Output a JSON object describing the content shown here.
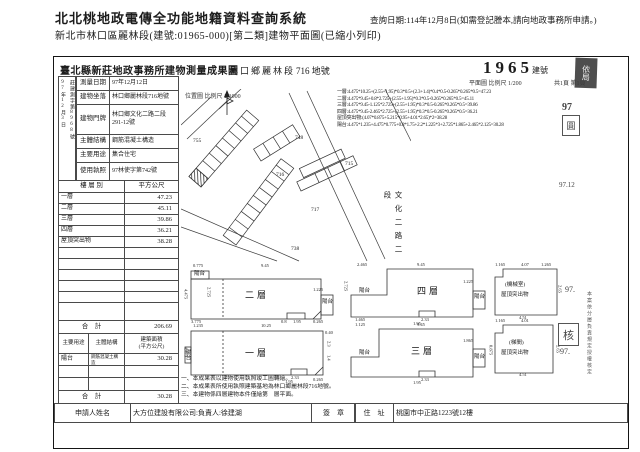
{
  "header": {
    "system_title": "北北桃地政電傳全功能地籍資料查詢系統",
    "query_date": "查詢日期:114年12月8日(如需登記謄本,請向地政事務所申請。)",
    "doc_line": "新北市林口區麗林段(建號:01965-000)[第二類]建物平面圖(已縮小列印)"
  },
  "form": {
    "title": "臺北縣新莊地政事務所建物測量成果圖",
    "section_name": "林口鄉麗林段",
    "parcel_no": "716 地號",
    "building_no": "1965",
    "building_no_label": "建號",
    "scale_site": "位置圖 比例尺 1/1000",
    "scale_plan": "平面圖 比例尺 1/200",
    "page_no": "共1頁 第1頁",
    "receipt": {
      "date": "97年12月3日",
      "no": "莊建測字第8968號"
    },
    "info_rows": [
      {
        "label": "測量日期",
        "value": "97年12月12日"
      },
      {
        "label": "建物坐落",
        "value": "林口鄉麗林段716地號"
      },
      {
        "label": "建物門牌",
        "value": "林口鄉文化二路二段291-12號"
      },
      {
        "label": "主體結構",
        "value": "鋼筋混凝土構造"
      },
      {
        "label": "主要用途",
        "value": "集合住宅"
      },
      {
        "label": "使用執照",
        "value": "97林使字第742號"
      }
    ],
    "floor_table": {
      "col_floor": "樓 層 別",
      "col_area": "平方公尺",
      "rows": [
        {
          "label": "一層",
          "value": "47.23"
        },
        {
          "label": "二層",
          "value": "45.11"
        },
        {
          "label": "三層",
          "value": "39.86"
        },
        {
          "label": "四層",
          "value": "36.21"
        },
        {
          "label": "屋頂突出物",
          "value": "38.28"
        }
      ],
      "total_label": "合　計",
      "total": "206.69"
    },
    "annex_table": {
      "col_use": "主要用途",
      "col_structure": "主體結構",
      "col_area": "建築面積",
      "col_area2": "(平方公尺)",
      "row": {
        "use": "陽台",
        "structure": "鋼筋混凝土構造",
        "area": "30.28"
      },
      "total_label": "合　計",
      "total": "30.28"
    },
    "applicant": {
      "label": "申請人姓名",
      "name": "大方位建設有限公司:負責人:徐建湖",
      "seal": "簽　章",
      "addr_label": "住　址",
      "address": "桃園市中正路1223號12樓"
    },
    "notes": [
      "一、本成果表以建物使用執照竣工圖轉繪。",
      "二、本成果表所使用執照建築基地為林口鄉麗林段716地號。",
      "三、本建物係四層建物本件僅繪第　層平面。"
    ],
    "calculations": [
      "一層:4.475*10.25+(2.55+1.95)*0.3*0.5+(2.3+1.4)*0.4*0.5-0.265*0.265*0.5=47.23",
      "二層:4.475*9.45+0.8*2.725+(2.55+1.95)*0.3*0.5-0.265*0.265*0.5=45.11",
      "三層:4.475*9.45-1.125*2.725+(2.55+1.95)*0.3*0.5-0.265*0.265*0.5=39.86",
      "四層:4.475*9.45-2.465*2.725+(2.55+1.95)*0.3*0.5-0.265*0.265*0.5=36.21",
      "屋頂突出物:(4.07*0.875+5.215*0.95+4.01*2.65)*2=38.28",
      "陽台:4.475*1.235+4.475*0.775+0.8*1.75+2.2*1.225*3+2.725*1.865+2.465*2.125=30.28"
    ],
    "site_plan": {
      "road_label": "文化二路二段",
      "labels": [
        {
          "t": "755",
          "x": 12,
          "y": 50,
          "b": 1
        },
        {
          "t": "748",
          "x": 114,
          "y": 47,
          "b": 1
        },
        {
          "t": "715",
          "x": 164,
          "y": 73,
          "b": 1
        },
        {
          "t": "716",
          "x": 95,
          "y": 84,
          "b": 1
        },
        {
          "t": "717",
          "x": 130,
          "y": 119,
          "b": 1
        },
        {
          "t": "738",
          "x": 110,
          "y": 158,
          "b": 1
        }
      ]
    },
    "floor_plans": {
      "labels": [
        {
          "t": "0.775",
          "x": 10,
          "y": 1
        },
        {
          "t": "9.45",
          "x": 78,
          "y": 1
        },
        {
          "t": "4.475",
          "x": 0,
          "y": 26,
          "v": 1
        },
        {
          "t": "陽台",
          "x": 11,
          "y": 9,
          "b": 1
        },
        {
          "t": "2.725",
          "x": 23,
          "y": 24,
          "v": 1
        },
        {
          "t": "二層",
          "x": 62,
          "y": 28,
          "n": 1
        },
        {
          "t": "1.225",
          "x": 130,
          "y": 25
        },
        {
          "t": "陽台",
          "x": 139,
          "y": 37,
          "b": 1
        },
        {
          "t": "3.775",
          "x": 8,
          "y": 57
        },
        {
          "t": "0.8",
          "x": 98,
          "y": 57
        },
        {
          "t": "1.95",
          "x": 110,
          "y": 57
        },
        {
          "t": "0.265",
          "x": 130,
          "y": 57
        },
        {
          "t": "1.235",
          "x": 10,
          "y": 61
        },
        {
          "t": "10.25",
          "x": 78,
          "y": 61
        },
        {
          "t": "4.475",
          "x": 0,
          "y": 84,
          "v": 1
        },
        {
          "t": "陽台",
          "x": 1,
          "y": 86,
          "v": 1,
          "b": 1
        },
        {
          "t": "一層",
          "x": 62,
          "y": 86,
          "n": 1
        },
        {
          "t": "0.40",
          "x": 142,
          "y": 68
        },
        {
          "t": "2.3",
          "x": 143,
          "y": 78,
          "v": 1
        },
        {
          "t": "1.4",
          "x": 143,
          "y": 92,
          "v": 1
        },
        {
          "t": "2.33",
          "x": 108,
          "y": 113
        },
        {
          "t": "1.95",
          "x": 102,
          "y": 117
        },
        {
          "t": "0.265",
          "x": 130,
          "y": 115
        },
        {
          "t": "2.465",
          "x": 174,
          "y": 0
        },
        {
          "t": "9.45",
          "x": 234,
          "y": 0
        },
        {
          "t": "2.725",
          "x": 160,
          "y": 18,
          "v": 1
        },
        {
          "t": "陽台",
          "x": 176,
          "y": 26,
          "b": 1
        },
        {
          "t": "1.465",
          "x": 172,
          "y": 55
        },
        {
          "t": "四層",
          "x": 234,
          "y": 24,
          "n": 1
        },
        {
          "t": "1.225",
          "x": 280,
          "y": 17
        },
        {
          "t": "陽台",
          "x": 291,
          "y": 32,
          "b": 1
        },
        {
          "t": "2.33",
          "x": 238,
          "y": 55
        },
        {
          "t": "1.95",
          "x": 230,
          "y": 59
        },
        {
          "t": "1.125",
          "x": 172,
          "y": 60
        },
        {
          "t": "9.45",
          "x": 234,
          "y": 60
        },
        {
          "t": "陽台",
          "x": 176,
          "y": 88,
          "b": 1
        },
        {
          "t": "三層",
          "x": 228,
          "y": 84,
          "n": 1
        },
        {
          "t": "1.865",
          "x": 280,
          "y": 76
        },
        {
          "t": "陽台",
          "x": 291,
          "y": 92,
          "b": 1
        },
        {
          "t": "2.33",
          "x": 238,
          "y": 115
        },
        {
          "t": "1.95",
          "x": 230,
          "y": 118
        },
        {
          "t": "1.165",
          "x": 312,
          "y": 0
        },
        {
          "t": "4.07",
          "x": 338,
          "y": 0
        },
        {
          "t": "1.265",
          "x": 358,
          "y": 0
        },
        {
          "t": "2.65",
          "x": 374,
          "y": 22,
          "v": 1
        },
        {
          "t": "(機械室)",
          "x": 322,
          "y": 20,
          "b": 1
        },
        {
          "t": "屋頂突出物",
          "x": 318,
          "y": 30,
          "b": 1
        },
        {
          "t": "4.51",
          "x": 336,
          "y": 53
        },
        {
          "t": "1.165",
          "x": 312,
          "y": 56
        },
        {
          "t": "4.01",
          "x": 338,
          "y": 56
        },
        {
          "t": "0.875",
          "x": 305,
          "y": 82,
          "v": 1
        },
        {
          "t": "(梯間)",
          "x": 326,
          "y": 78,
          "b": 1
        },
        {
          "t": "屋頂突出物",
          "x": 318,
          "y": 88,
          "b": 1
        },
        {
          "t": "2.65",
          "x": 372,
          "y": 82,
          "v": 1
        },
        {
          "t": "4.51",
          "x": 336,
          "y": 110
        }
      ]
    },
    "stamps": {
      "corner": "依局",
      "y97": "97",
      "seal1": "圓",
      "date": "97.12",
      "y97b": "97.",
      "seal2": "核",
      "y97c": "97.",
      "strip": "本案依分層負責規定授權核定"
    }
  }
}
